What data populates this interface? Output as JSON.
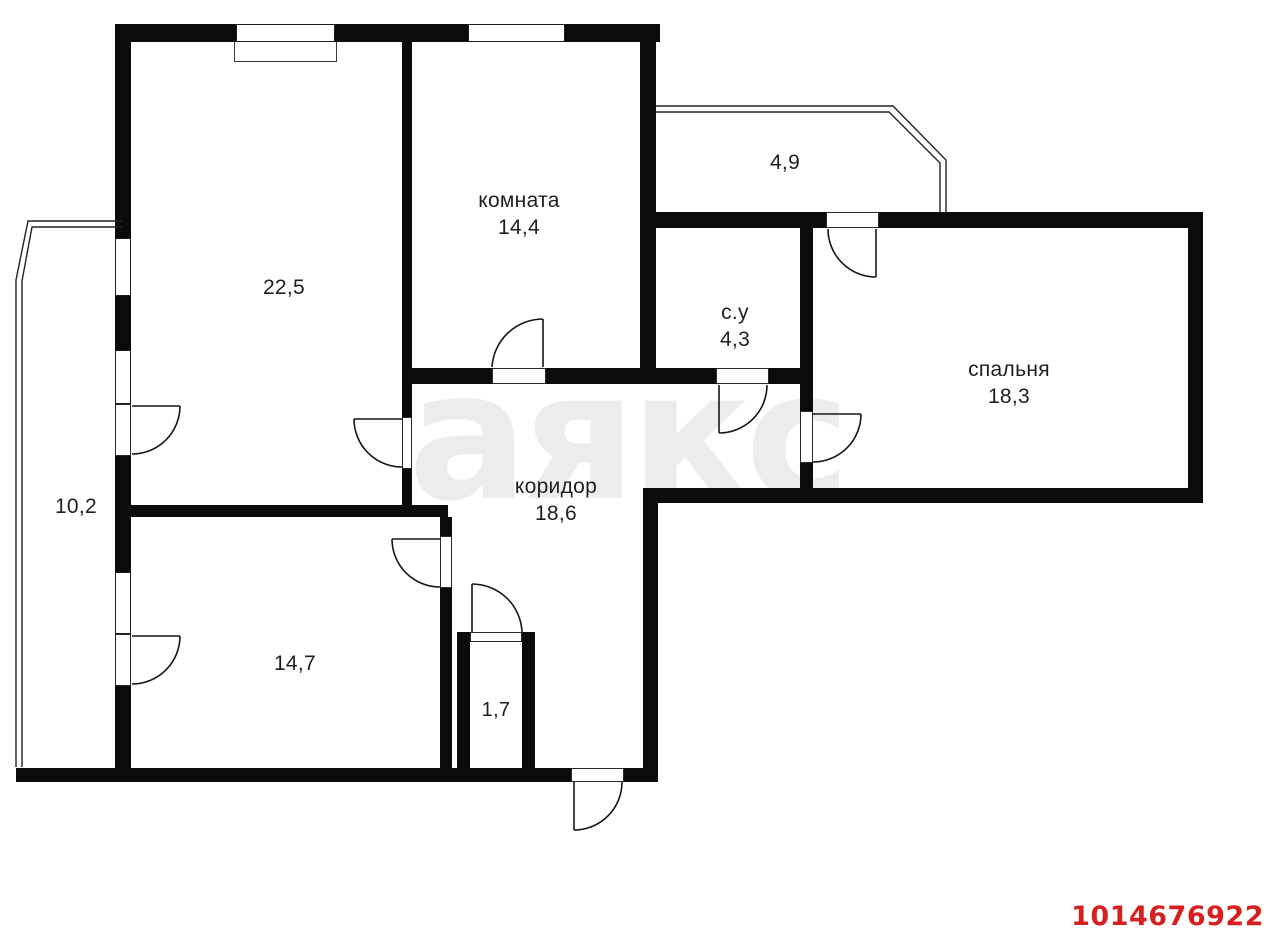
{
  "plan": {
    "watermark": "аякс",
    "plan_id": "1014676922",
    "colors": {
      "wall": "#0b0b0b",
      "background": "#ffffff",
      "watermark": "#ececec",
      "plan_id_red": "#d61f1f",
      "label": "#1f1f1f"
    }
  },
  "rooms": [
    {
      "name": "room-22-5",
      "label": "",
      "area": "22,5"
    },
    {
      "name": "komnata",
      "label": "комната",
      "area": "14,4"
    },
    {
      "name": "su",
      "label": "с.у",
      "area": "4,3"
    },
    {
      "name": "spalnya",
      "label": "спальня",
      "area": "18,3"
    },
    {
      "name": "koridor",
      "label": "коридор",
      "area": "18,6"
    },
    {
      "name": "room-14-7",
      "label": "",
      "area": "14,7"
    },
    {
      "name": "closet-1-7",
      "label": "",
      "area": "1,7"
    },
    {
      "name": "balcony-left",
      "label": "",
      "area": "10,2"
    },
    {
      "name": "balcony-top",
      "label": "",
      "area": "4,9"
    }
  ]
}
